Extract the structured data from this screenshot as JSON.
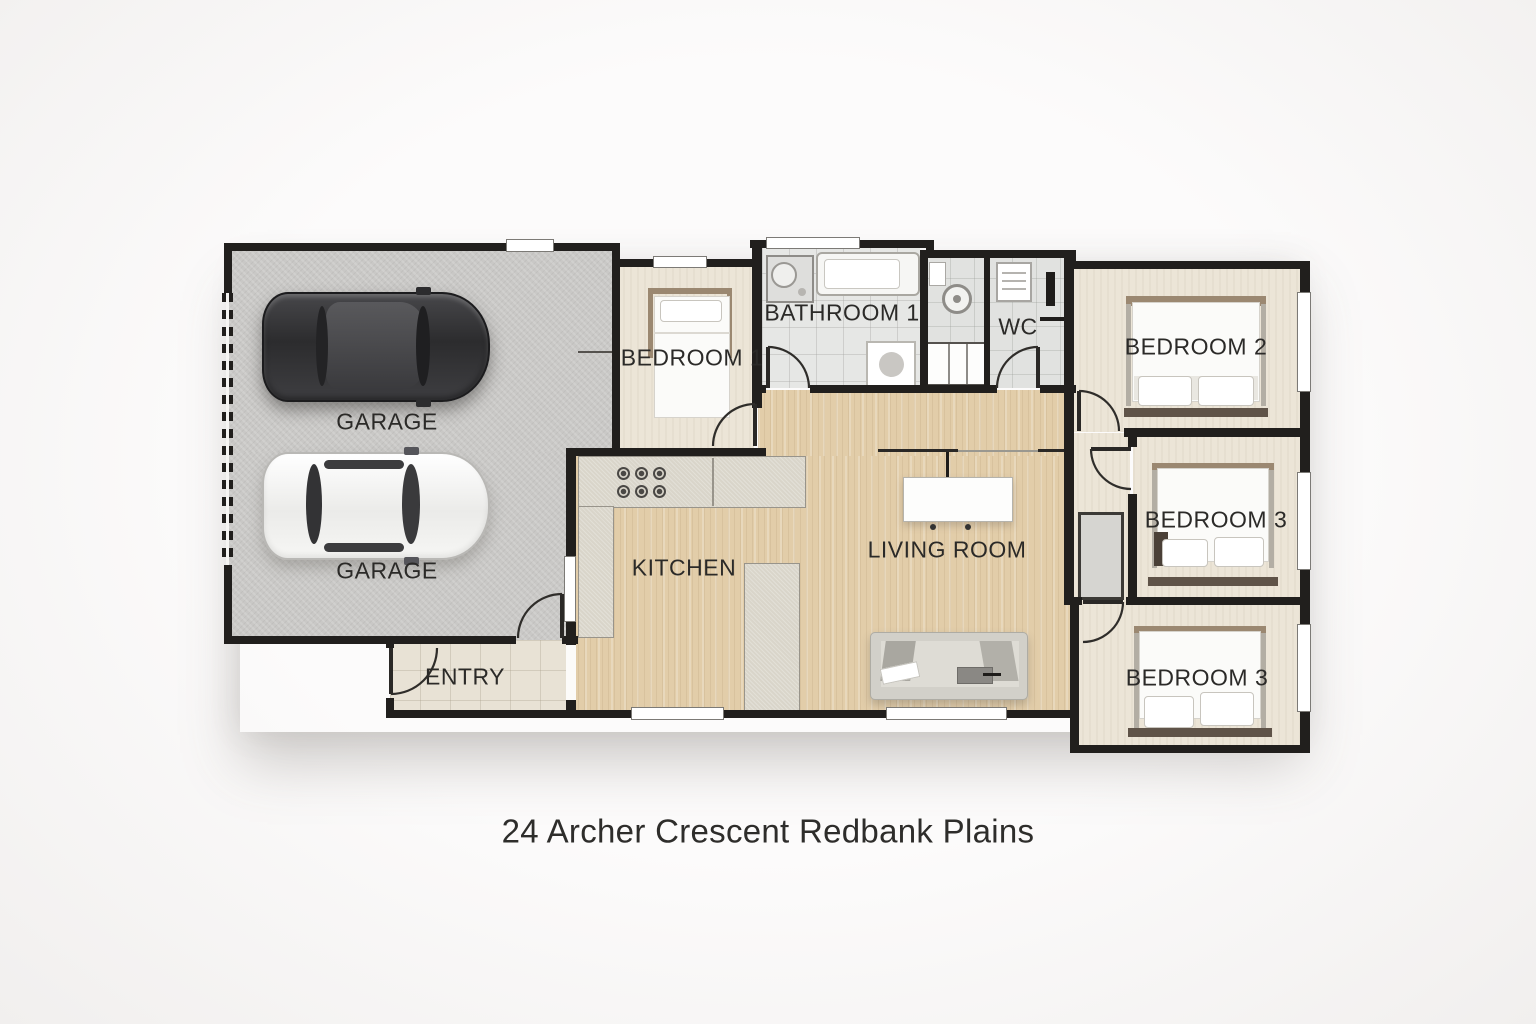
{
  "title": "24 Archer Crescent Redbank Plains",
  "rooms": {
    "garage": {
      "label_upper": "GARAGE",
      "label_lower": "GARAGE"
    },
    "entry": {
      "label": "ENTRY"
    },
    "bedroom1": {
      "label": "BEDROOM 1"
    },
    "bathroom1": {
      "label": "BATHROOM 1"
    },
    "wc": {
      "label": "WC"
    },
    "bedroom2": {
      "label": "BEDROOM 2"
    },
    "bedroom3_middle": {
      "label": "BEDROOM 3"
    },
    "bedroom3_bottom": {
      "label": "BEDROOM 3"
    },
    "kitchen": {
      "label": "KITCHEN"
    },
    "living_room": {
      "label": "LIVING ROOM"
    }
  },
  "colors": {
    "wall": "#211f1d",
    "wood_floor": "#e2cda9",
    "carpet": "#ece5d7",
    "garage_floor": "#c9c8c6",
    "entry_tile": "#e8e2d5",
    "bath_tile": "#e6e7e5",
    "counter_stone": "#d9d5ca",
    "bed_frame_wood": "#9b8871",
    "bench_wood": "#5f5348"
  }
}
